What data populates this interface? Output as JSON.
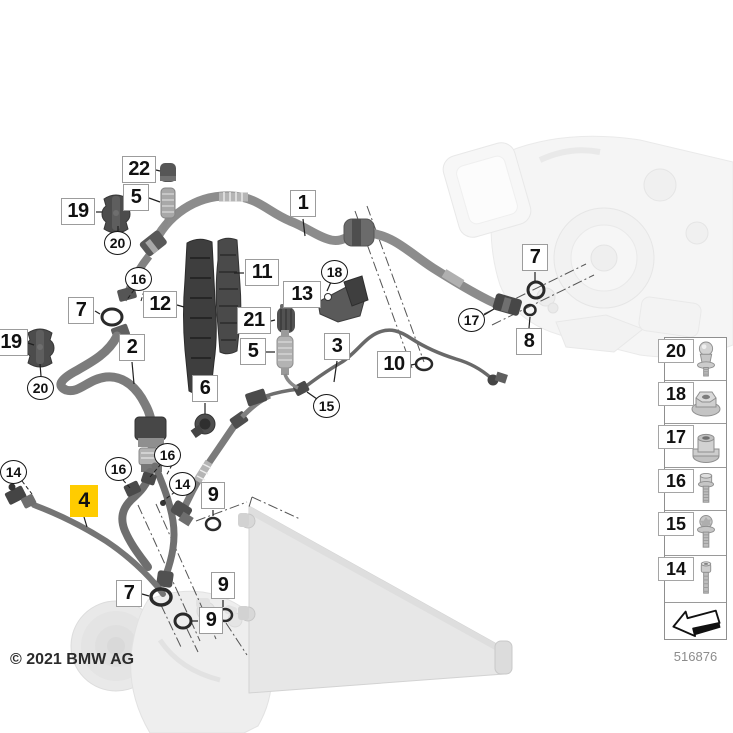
{
  "meta": {
    "copyright": "© 2021 BMW AG",
    "diagram_number": "516876"
  },
  "highlight": {
    "color": "#FFCC00",
    "highlighted_callout": "4"
  },
  "callouts": {
    "items": [
      {
        "label": "22",
        "shape": "box"
      },
      {
        "label": "5",
        "shape": "box"
      },
      {
        "label": "19",
        "shape": "box"
      },
      {
        "label": "20",
        "shape": "circle"
      },
      {
        "label": "16",
        "shape": "circle"
      },
      {
        "label": "7",
        "shape": "box"
      },
      {
        "label": "12",
        "shape": "box"
      },
      {
        "label": "11",
        "shape": "box"
      },
      {
        "label": "1",
        "shape": "box"
      },
      {
        "label": "2",
        "shape": "box"
      },
      {
        "label": "19",
        "shape": "box"
      },
      {
        "label": "20",
        "shape": "circle"
      },
      {
        "label": "18",
        "shape": "circle"
      },
      {
        "label": "13",
        "shape": "box"
      },
      {
        "label": "21",
        "shape": "box"
      },
      {
        "label": "5",
        "shape": "box"
      },
      {
        "label": "3",
        "shape": "box"
      },
      {
        "label": "10",
        "shape": "box"
      },
      {
        "label": "15",
        "shape": "circle"
      },
      {
        "label": "6",
        "shape": "box"
      },
      {
        "label": "7",
        "shape": "box"
      },
      {
        "label": "17",
        "shape": "circle"
      },
      {
        "label": "8",
        "shape": "box"
      },
      {
        "label": "14",
        "shape": "circle"
      },
      {
        "label": "4",
        "shape": "box-highlighted"
      },
      {
        "label": "16",
        "shape": "circle"
      },
      {
        "label": "16",
        "shape": "circle"
      },
      {
        "label": "14",
        "shape": "circle"
      },
      {
        "label": "9",
        "shape": "box"
      },
      {
        "label": "7",
        "shape": "box"
      },
      {
        "label": "9",
        "shape": "box"
      },
      {
        "label": "9",
        "shape": "box"
      }
    ]
  },
  "sidebar": {
    "items": [
      {
        "label": "20",
        "icon": "ball-stud"
      },
      {
        "label": "18",
        "icon": "flange-nut"
      },
      {
        "label": "17",
        "icon": "compression-nut"
      },
      {
        "label": "16",
        "icon": "hex-flange-bolt"
      },
      {
        "label": "15",
        "icon": "torx-flange-screw"
      },
      {
        "label": "14",
        "icon": "cheese-head-screw"
      }
    ],
    "arrow_icon": "driving-direction-arrow"
  }
}
